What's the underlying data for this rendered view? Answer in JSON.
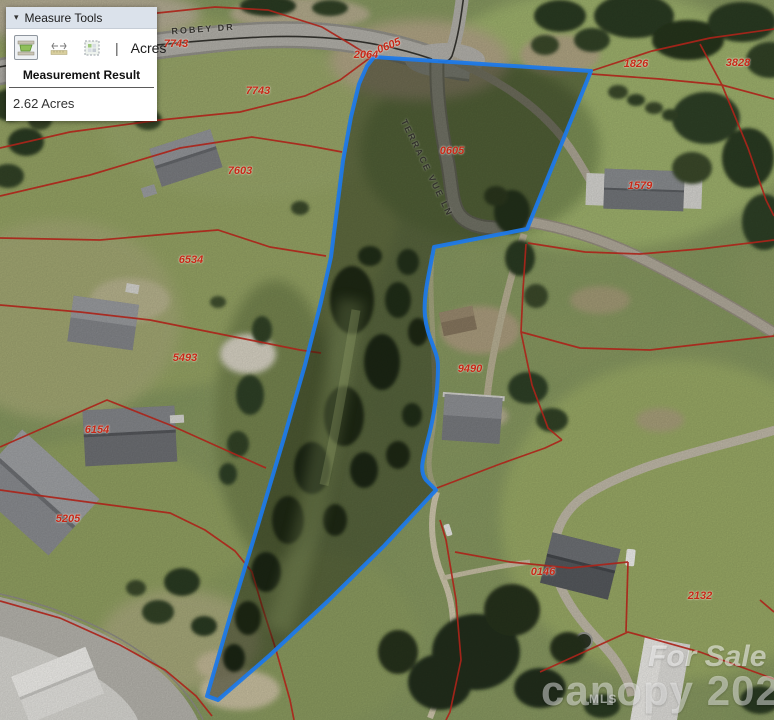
{
  "measure_panel": {
    "title": "Measure Tools",
    "collapse_arrow": "▾",
    "tools": [
      {
        "id": "area",
        "name": "area-measure-tool",
        "active": true
      },
      {
        "id": "distance",
        "name": "distance-measure-tool",
        "active": false
      },
      {
        "id": "location",
        "name": "location-tool",
        "active": false
      }
    ],
    "separator": "|",
    "unit": "Acres",
    "result_heading": "Measurement Result",
    "result_value": "2.62 Acres"
  },
  "map": {
    "selected_parcel_outline_color": "#1d79e8",
    "parcel_line_color": "#ab241a",
    "parcel_label_color": "#c62817",
    "road_labels": [
      {
        "text": "ROBEY DR",
        "x": 203,
        "y": 29,
        "rot": -4
      },
      {
        "text": "TERRACE VUE LN",
        "x": 427,
        "y": 168,
        "rot": 64
      }
    ],
    "parcel_labels": [
      {
        "text": "7743",
        "x": 176,
        "y": 44,
        "rot": 0
      },
      {
        "text": "7743",
        "x": 258,
        "y": 91,
        "rot": 0
      },
      {
        "text": "7603",
        "x": 240,
        "y": 171,
        "rot": 0
      },
      {
        "text": "6534",
        "x": 191,
        "y": 260,
        "rot": 0
      },
      {
        "text": "5493",
        "x": 185,
        "y": 358,
        "rot": 0
      },
      {
        "text": "6154",
        "x": 97,
        "y": 430,
        "rot": 0
      },
      {
        "text": "5205",
        "x": 68,
        "y": 519,
        "rot": 0
      },
      {
        "text": "2064",
        "x": 366,
        "y": 55,
        "rot": 0
      },
      {
        "text": "0605",
        "x": 389,
        "y": 46,
        "rot": -22
      },
      {
        "text": "0605",
        "x": 452,
        "y": 151,
        "rot": 0
      },
      {
        "text": "1826",
        "x": 636,
        "y": 64,
        "rot": 0
      },
      {
        "text": "3828",
        "x": 738,
        "y": 63,
        "rot": 0
      },
      {
        "text": "1579",
        "x": 640,
        "y": 186,
        "rot": 0
      },
      {
        "text": "9490",
        "x": 470,
        "y": 369,
        "rot": 0
      },
      {
        "text": "0146",
        "x": 543,
        "y": 572,
        "rot": 0
      },
      {
        "text": "2132",
        "x": 700,
        "y": 596,
        "rot": 0
      }
    ]
  },
  "watermark": {
    "sale_text": "For Sale",
    "mls_text": "MLS",
    "brand_text": "canopy 2023"
  }
}
